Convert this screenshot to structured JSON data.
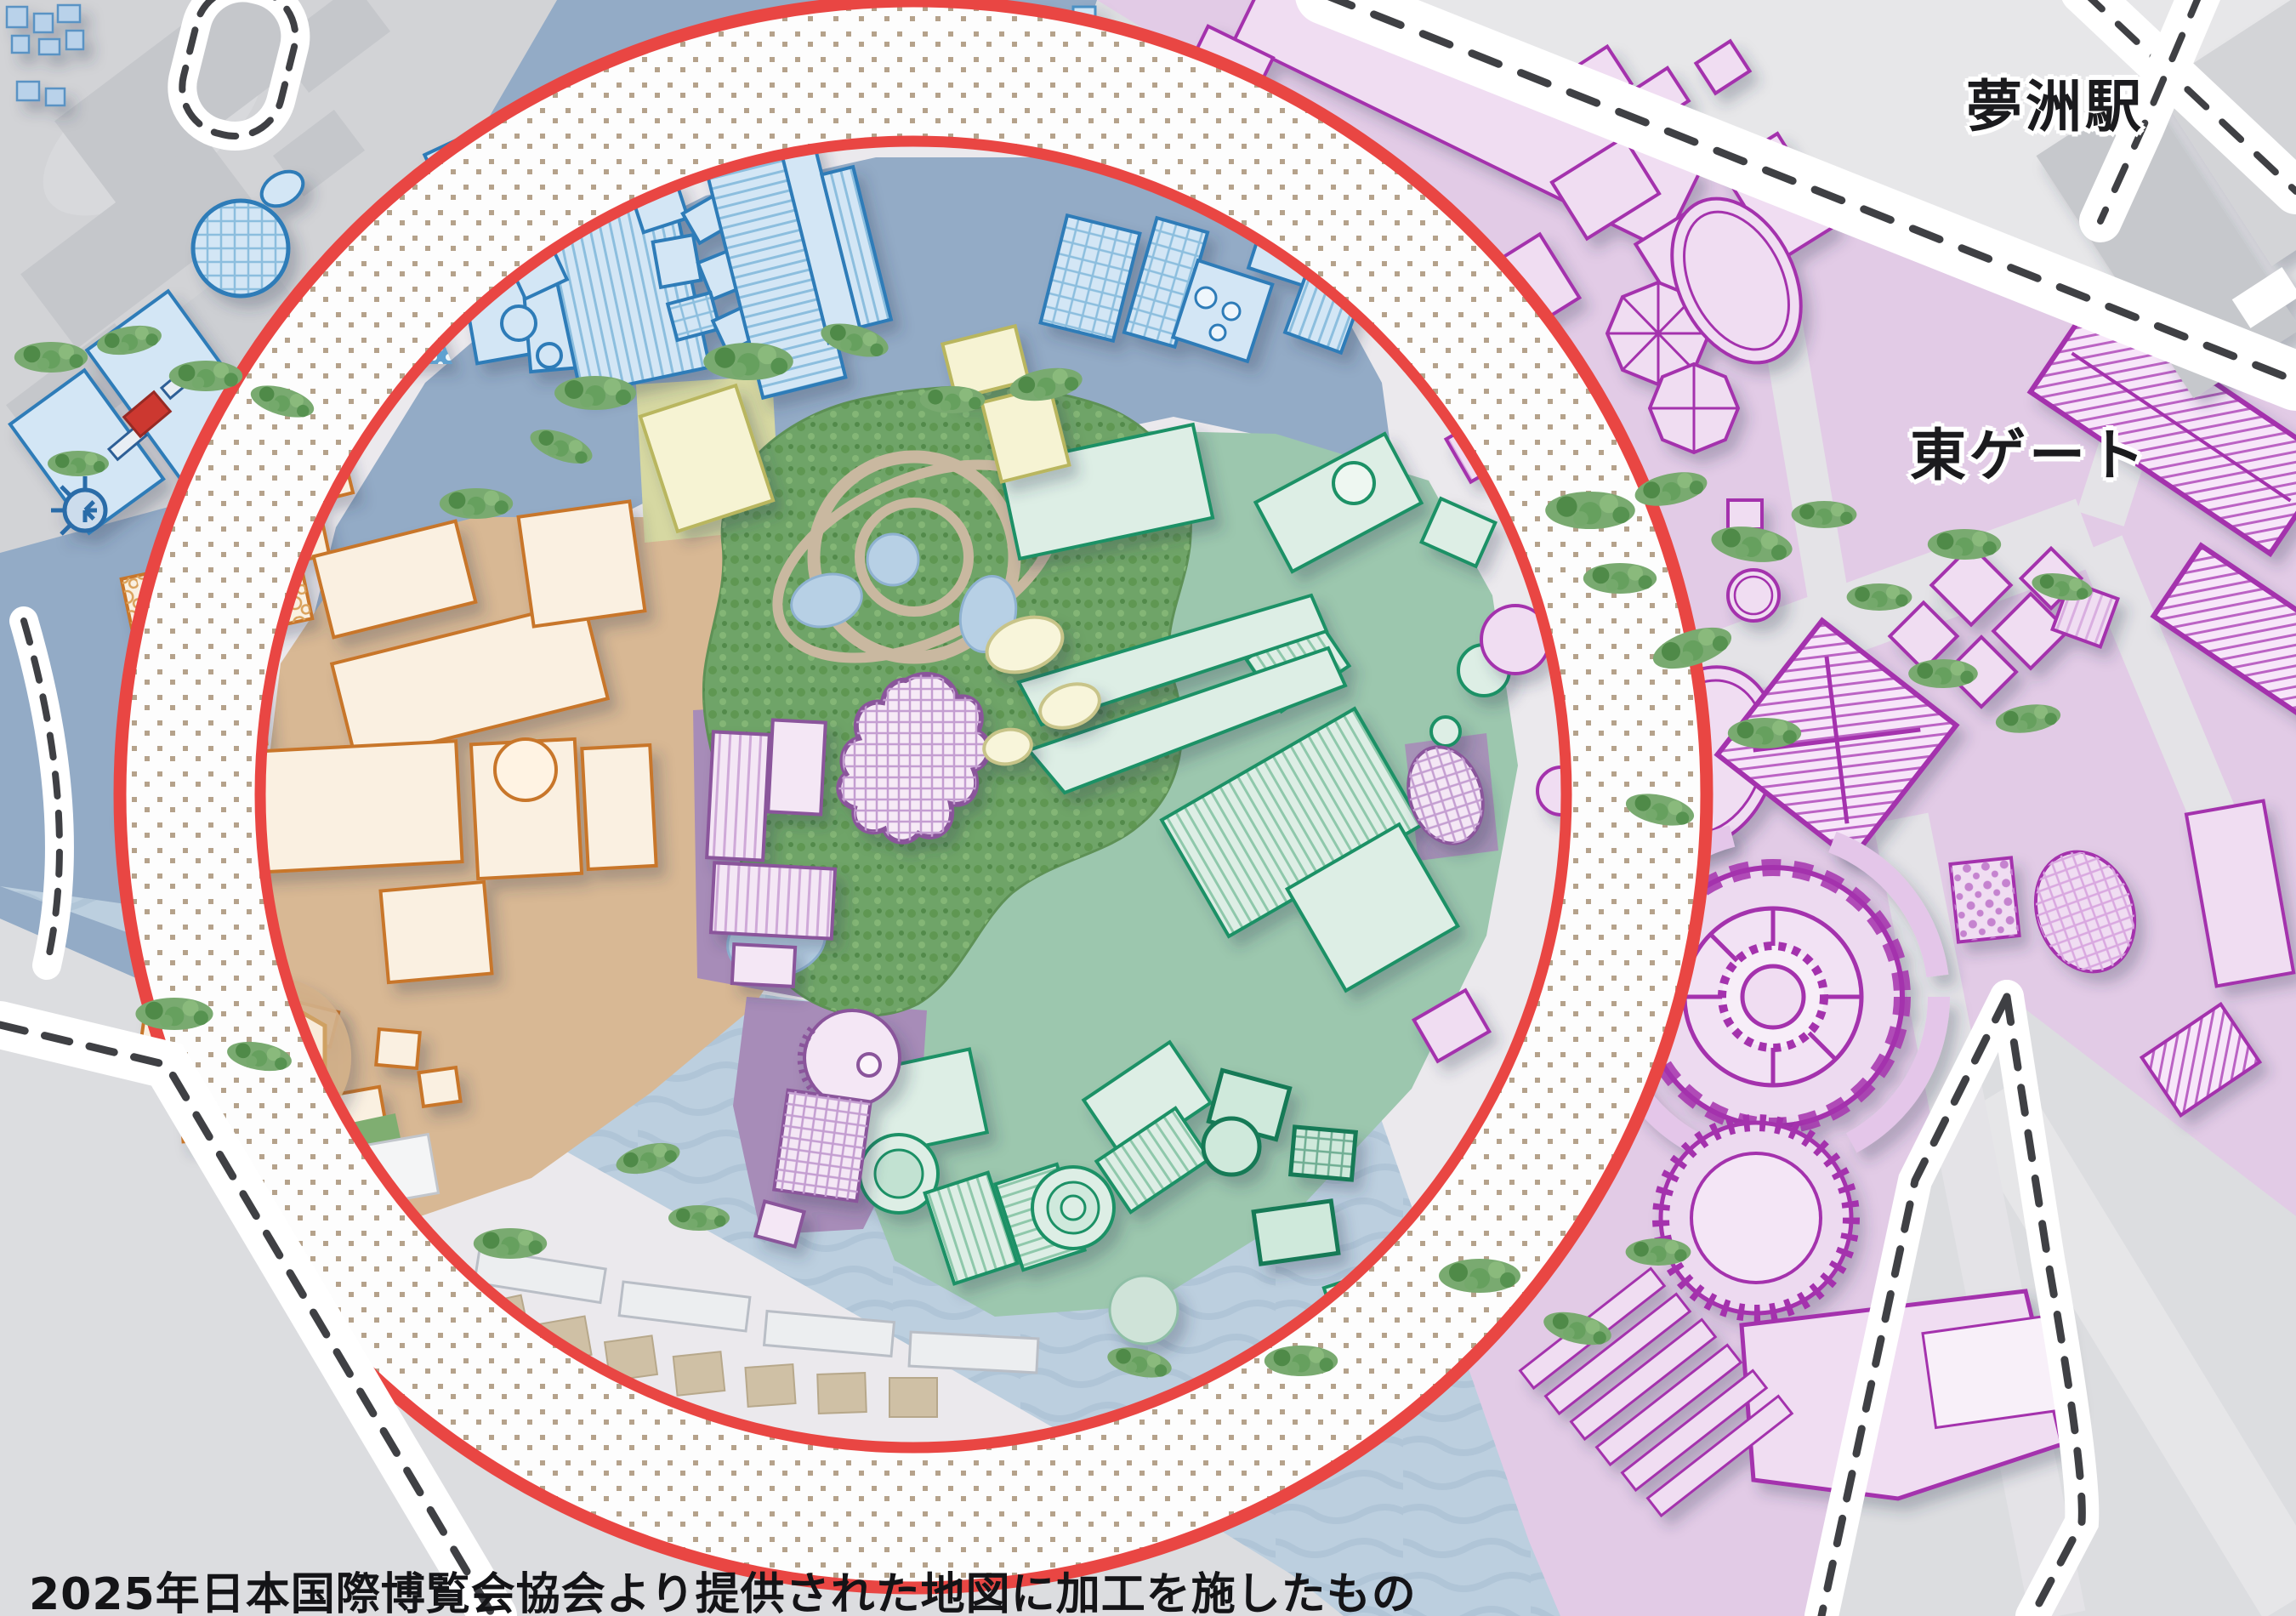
{
  "map": {
    "labels": {
      "station": "夢洲駅",
      "east_gate": "東ゲート",
      "attribution": "2025年日本国際博覧会協会より提供された地図に加工を施したもの"
    },
    "colors": {
      "grand_ring_red": "#e94643",
      "ring_dot_tan": "#b5a28b",
      "water_blue": "#bccfdf",
      "land_gray": "#dcdde0",
      "zone_blue_outline": "#2e7cb8",
      "zone_blue_bg": "#93abc6",
      "zone_orange_outline": "#c8762a",
      "zone_orange_bg": "#d8b894",
      "zone_green_outline": "#1d9166",
      "zone_green_bg": "#9cc7ae",
      "zone_pink_outline": "#a433ad",
      "zone_pink_bg": "#e2cbe6",
      "zone_purple_outline": "#8a549b",
      "zone_purple_bg": "#a78cb8",
      "zone_yellow_bg": "#d6d8a2",
      "forest_green": "#6fa468",
      "boundary_dash": "#3f4044"
    }
  }
}
